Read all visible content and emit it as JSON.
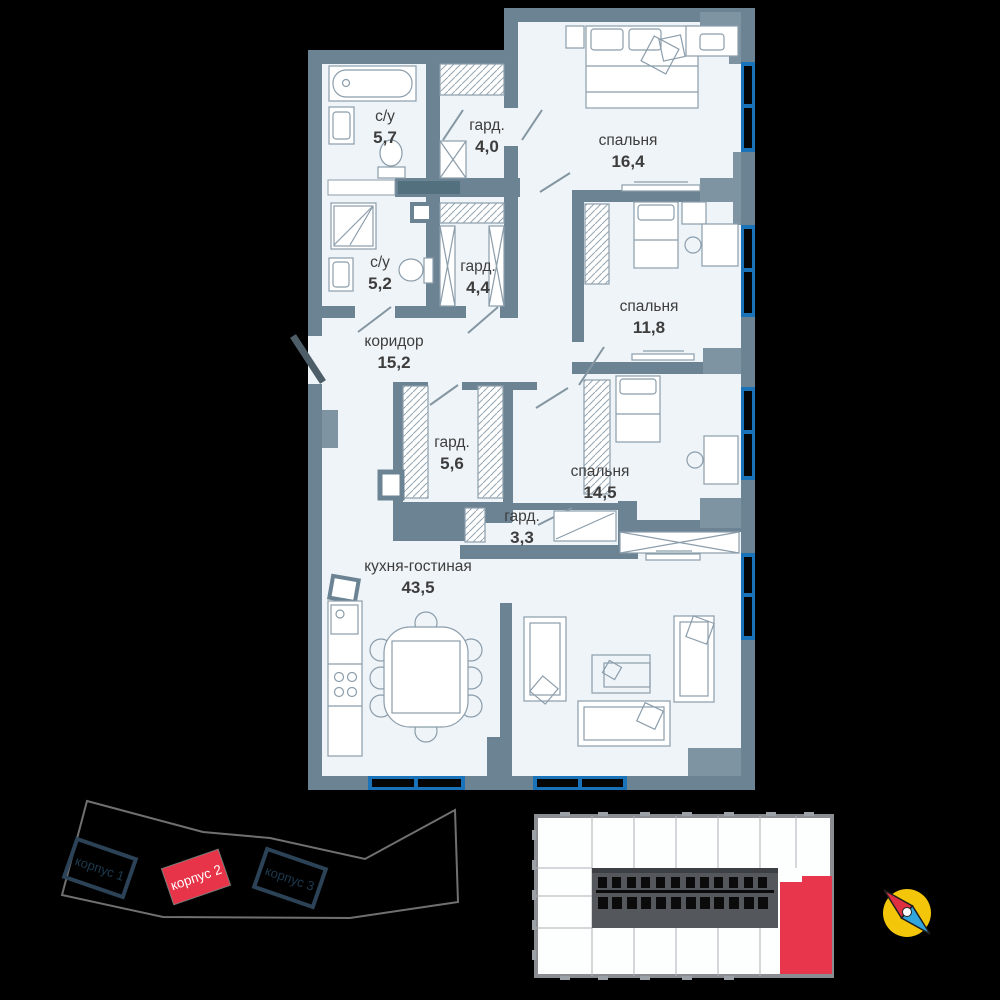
{
  "plan": {
    "rooms": [
      {
        "name": "с/у",
        "area": "5,7"
      },
      {
        "name": "гард.",
        "area": "4,0"
      },
      {
        "name": "спальня",
        "area": "16,4"
      },
      {
        "name": "с/у",
        "area": "5,2"
      },
      {
        "name": "гард.",
        "area": "4,4"
      },
      {
        "name": "спальня",
        "area": "11,8"
      },
      {
        "name": "коридор",
        "area": "15,2"
      },
      {
        "name": "гард.",
        "area": "5,6"
      },
      {
        "name": "спальня",
        "area": "14,5"
      },
      {
        "name": "гард.",
        "area": "3,3"
      },
      {
        "name": "кухня-гостиная",
        "area": "43,5"
      }
    ]
  },
  "site_plan": {
    "buildings": [
      {
        "label": "корпус 1",
        "highlighted": false
      },
      {
        "label": "корпус 2",
        "highlighted": true
      },
      {
        "label": "корпус 3",
        "highlighted": false
      }
    ]
  },
  "floor_plate": {
    "highlighted_unit": "selected-apartment"
  },
  "icons": {
    "compass": "compass-icon"
  },
  "colors": {
    "wall": "#6b8392",
    "floor": "#eff4f8",
    "window": "#1a73b8",
    "accent_red": "#e73448",
    "compass_yellow": "#f4c60a"
  }
}
